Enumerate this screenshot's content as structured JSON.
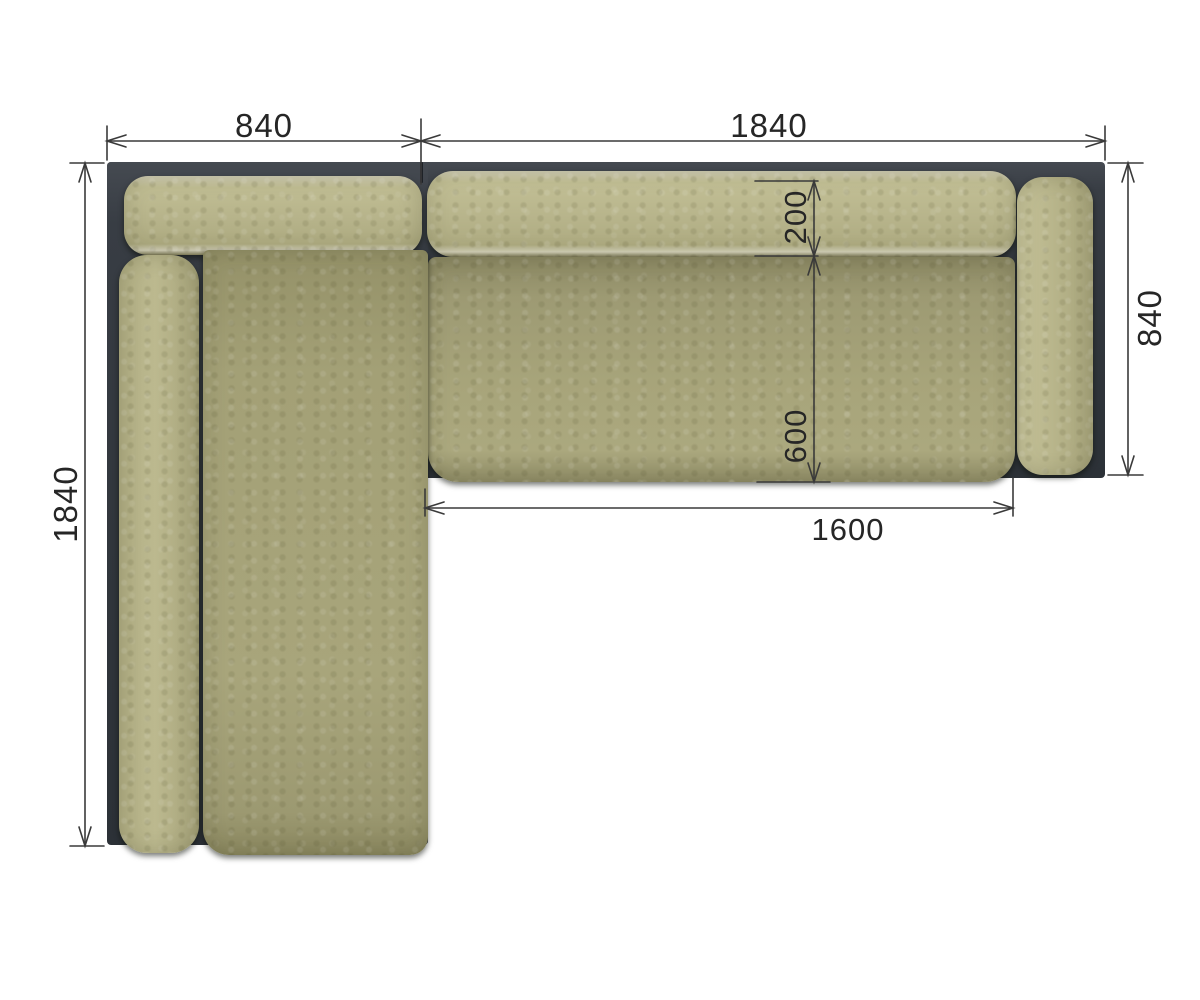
{
  "diagram": {
    "title": "corner-sofa-top-view-dimension-drawing",
    "colors": {
      "background": "#ffffff",
      "frame": "#32373d",
      "back_cushion": "#b7b48b",
      "seat_cushion": "#a7a47a",
      "dimension_line": "#3a3a3a",
      "dimension_text": "#262626"
    },
    "dimensions": {
      "top_chaise_width": "840",
      "top_main_width": "1840",
      "left_chaise_length": "1840",
      "right_side_depth": "840",
      "back_cushion_depth": "200",
      "seat_depth": "600",
      "seat_width": "1600"
    }
  }
}
